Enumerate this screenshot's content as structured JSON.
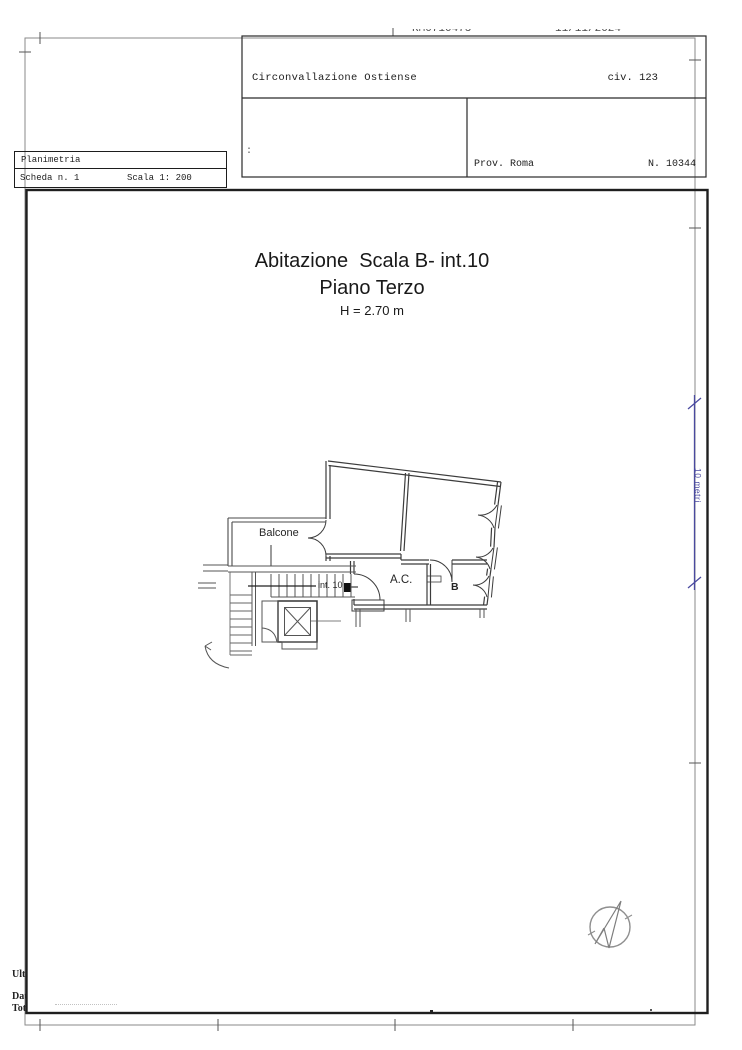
{
  "document": {
    "top_strip": {
      "fragment_left": "RM0710475",
      "fragment_right": "11/11/2024"
    },
    "header_box": {
      "street": "Circonvallazione Ostiense",
      "civic": "civ. 123",
      "separator": ":",
      "province": "Prov. Roma",
      "sheet_number": "N. 10344"
    },
    "sheet_box": {
      "title": "Planimetria",
      "sheet": "Scheda n. 1",
      "scale": "Scala 1: 200"
    },
    "plan_title": {
      "line1": "Abitazione  Scala B- int.10",
      "line2": "Piano Terzo",
      "line3": "H = 2.70 m"
    },
    "plan_labels": {
      "balcony": "Balcone",
      "unit": "int. 10",
      "room_ac": "A.C.",
      "room_b": "B"
    },
    "scale_bar": {
      "label": "10 metri",
      "color": "#4a4aa0"
    },
    "footer_fragments": {
      "line1": "Ult",
      "line2": "Dat",
      "line3": "Tot"
    },
    "icons": {
      "compass": "north-compass-icon"
    },
    "colors": {
      "paper": "#ffffff",
      "frame_gray": "#8a8a8a",
      "border_dark": "#1f1f1f",
      "ink": "#1c1c1c",
      "plan_line": "#3c3c3c",
      "scale_blue": "#4a4aa0"
    }
  }
}
